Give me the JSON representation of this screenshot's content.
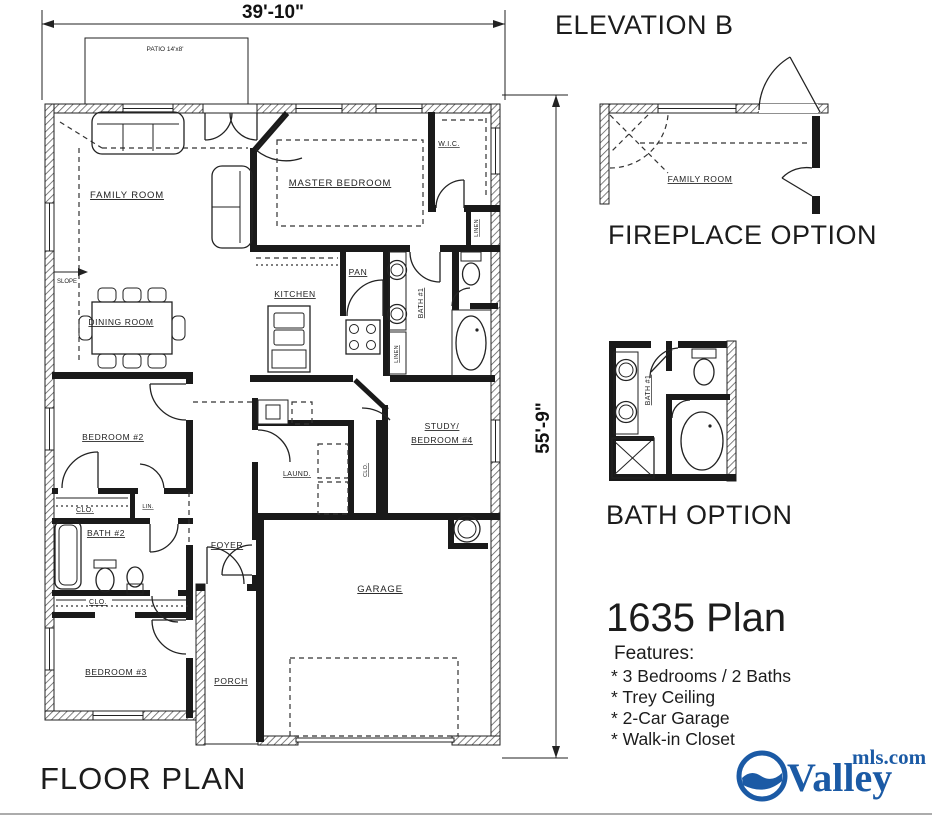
{
  "dimensions": {
    "width_label": "39'-10\"",
    "height_label": "55'-9\""
  },
  "floor_plan": {
    "title": "FLOOR PLAN",
    "patio_label": "PATIO 14'x8'",
    "slope_label": "SLOPE",
    "rooms": {
      "family_room": "FAMILY ROOM",
      "dining_room": "DINING ROOM",
      "kitchen": "KITCHEN",
      "pantry": "PAN",
      "master_bedroom": "MASTER BEDROOM",
      "wic": "W.I.C.",
      "linen_master": "LINEN",
      "linen_hall": "LINEN",
      "bath1": "BATH #1",
      "bedroom2": "BEDROOM #2",
      "closet_bedroom2": "CLO.",
      "linen_small": "LIN.",
      "bath2": "BATH #2",
      "closet_hall": "CLO.",
      "bedroom3": "BEDROOM #3",
      "study_line1": "STUDY/",
      "study_line2": "BEDROOM #4",
      "laundry": "LAUND.",
      "closet_study": "CLO.",
      "foyer": "FOYER",
      "garage": "GARAGE",
      "porch": "PORCH"
    }
  },
  "elevation": {
    "title": "ELEVATION B"
  },
  "fireplace_option": {
    "title": "FIREPLACE OPTION",
    "room_label": "FAMILY ROOM"
  },
  "bath_option": {
    "title": "BATH OPTION",
    "room_label": "BATH #1"
  },
  "plan_info": {
    "name": "1635 Plan",
    "features_heading": "Features:",
    "features": [
      "* 3 Bedrooms / 2 Baths",
      "* Trey Ceiling",
      "* 2-Car Garage",
      "* Walk-in Closet"
    ]
  },
  "logo": {
    "name": "Valley",
    "suffix": "mls.com",
    "color": "#1b5aa5"
  },
  "colors": {
    "ink": "#1a1a1a",
    "background": "#ffffff"
  }
}
